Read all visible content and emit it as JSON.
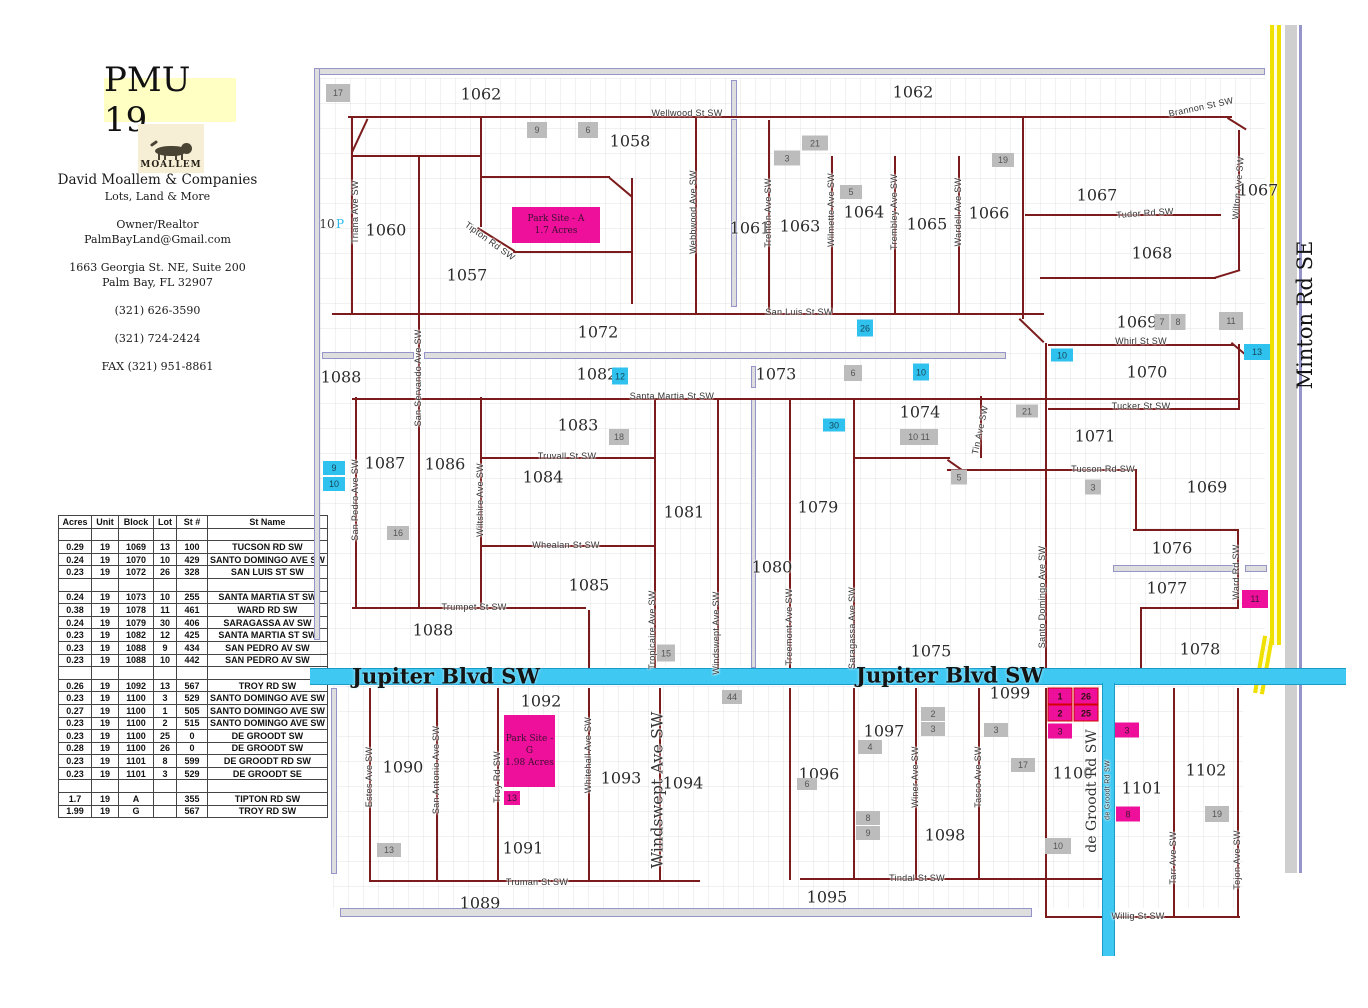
{
  "header": {
    "title": "PMU 19",
    "logo_text": "MOALLEM",
    "company": "David Moallem & Companies",
    "tagline": "Lots, Land & More",
    "role": "Owner/Realtor",
    "email": "PalmBayLand@Gmail.com",
    "address1": "1663 Georgia St. NE, Suite 200",
    "address2": "Palm Bay, FL   32907",
    "phone1": "(321) 626-3590",
    "phone2": "(321) 724-2424",
    "fax": "FAX (321) 951-8861"
  },
  "table": {
    "headers": [
      "Acres",
      "Unit",
      "Block",
      "Lot",
      "St #",
      "St Name"
    ],
    "rows": [
      [
        "",
        "",
        "",
        "",
        "",
        ""
      ],
      [
        "0.29",
        "19",
        "1069",
        "13",
        "100",
        "TUCSON RD SW"
      ],
      [
        "0.24",
        "19",
        "1070",
        "10",
        "429",
        "SANTO DOMINGO AVE SW"
      ],
      [
        "0.23",
        "19",
        "1072",
        "26",
        "328",
        "SAN LUIS ST SW"
      ],
      [
        "",
        "",
        "",
        "",
        "",
        ""
      ],
      [
        "0.24",
        "19",
        "1073",
        "10",
        "255",
        "SANTA MARTIA ST  SW"
      ],
      [
        "0.38",
        "19",
        "1078",
        "11",
        "461",
        "WARD RD SW"
      ],
      [
        "0.24",
        "19",
        "1079",
        "30",
        "406",
        "SARAGASSA AV  SW"
      ],
      [
        "0.23",
        "19",
        "1082",
        "12",
        "425",
        "SANTA MARTIA ST  SW"
      ],
      [
        "0.23",
        "19",
        "1088",
        "9",
        "434",
        "SAN PEDRO AV  SW"
      ],
      [
        "0.23",
        "19",
        "1088",
        "10",
        "442",
        "SAN PEDRO AV  SW"
      ],
      [
        "",
        "",
        "",
        "",
        "",
        ""
      ],
      [
        "0.26",
        "19",
        "1092",
        "13",
        "567",
        "TROY RD SW"
      ],
      [
        "0.23",
        "19",
        "1100",
        "3",
        "529",
        "SANTO DOMINGO AVE SW"
      ],
      [
        "0.27",
        "19",
        "1100",
        "1",
        "505",
        "SANTO DOMINGO AVE SW"
      ],
      [
        "0.23",
        "19",
        "1100",
        "2",
        "515",
        "SANTO DOMINGO AVE SW"
      ],
      [
        "0.23",
        "19",
        "1100",
        "25",
        "0",
        "DE GROODT SW"
      ],
      [
        "0.28",
        "19",
        "1100",
        "26",
        "0",
        "DE GROODT SW"
      ],
      [
        "0.23",
        "19",
        "1101",
        "8",
        "599",
        "DE GROODT RD  SW"
      ],
      [
        "0.23",
        "19",
        "1101",
        "3",
        "529",
        "DE GROODT  SE"
      ],
      [
        "",
        "",
        "",
        "",
        "",
        ""
      ],
      [
        "1.7",
        "19",
        "A",
        "",
        "355",
        "TIPTON RD  SW"
      ],
      [
        "1.99",
        "19",
        "G",
        "",
        "567",
        "TROY RD  SW"
      ]
    ]
  },
  "map": {
    "roads": {
      "jupiter": {
        "label": "Jupiter Blvd SW"
      },
      "minton": {
        "label": "Minton Rd SE"
      },
      "degroodt": {
        "label": "de Groodt Rd SW"
      }
    },
    "park_sites": [
      {
        "l1": "Park Site - A",
        "l2": "1.7 Acres",
        "x": 512,
        "y": 207,
        "w": 88,
        "h": 36
      },
      {
        "l1": "Park Site - G",
        "l2": "1.98 Acres",
        "x": 504,
        "y": 715,
        "w": 51,
        "h": 72
      }
    ],
    "block_labels": [
      {
        "t": "1062",
        "x": 481,
        "y": 94
      },
      {
        "t": "1062",
        "x": 913,
        "y": 92
      },
      {
        "t": "1058",
        "x": 630,
        "y": 141
      },
      {
        "t": "1060",
        "x": 386,
        "y": 230
      },
      {
        "t": "1057",
        "x": 467,
        "y": 275
      },
      {
        "t": "1061",
        "x": 750,
        "y": 228
      },
      {
        "t": "1063",
        "x": 800,
        "y": 226
      },
      {
        "t": "1064",
        "x": 864,
        "y": 212
      },
      {
        "t": "1065",
        "x": 927,
        "y": 224
      },
      {
        "t": "1066",
        "x": 989,
        "y": 213
      },
      {
        "t": "1067",
        "x": 1097,
        "y": 195
      },
      {
        "t": "1067",
        "x": 1258,
        "y": 190
      },
      {
        "t": "1068",
        "x": 1152,
        "y": 253
      },
      {
        "t": "1072",
        "x": 598,
        "y": 332
      },
      {
        "t": "1069",
        "x": 1137,
        "y": 322
      },
      {
        "t": "1070",
        "x": 1147,
        "y": 372
      },
      {
        "t": "1088",
        "x": 341,
        "y": 377
      },
      {
        "t": "1082",
        "x": 597,
        "y": 374
      },
      {
        "t": "1073",
        "x": 776,
        "y": 374
      },
      {
        "t": "1074",
        "x": 920,
        "y": 412
      },
      {
        "t": "1071",
        "x": 1095,
        "y": 436
      },
      {
        "t": "1083",
        "x": 578,
        "y": 425
      },
      {
        "t": "1087",
        "x": 385,
        "y": 463
      },
      {
        "t": "1086",
        "x": 445,
        "y": 464
      },
      {
        "t": "1084",
        "x": 543,
        "y": 477
      },
      {
        "t": "1081",
        "x": 684,
        "y": 512
      },
      {
        "t": "1079",
        "x": 818,
        "y": 507
      },
      {
        "t": "1069",
        "x": 1207,
        "y": 487
      },
      {
        "t": "1080",
        "x": 772,
        "y": 567
      },
      {
        "t": "1076",
        "x": 1172,
        "y": 548
      },
      {
        "t": "1085",
        "x": 589,
        "y": 585
      },
      {
        "t": "1077",
        "x": 1167,
        "y": 588
      },
      {
        "t": "1088",
        "x": 433,
        "y": 630
      },
      {
        "t": "1075",
        "x": 931,
        "y": 651
      },
      {
        "t": "1078",
        "x": 1200,
        "y": 649
      },
      {
        "t": "1092",
        "x": 541,
        "y": 701
      },
      {
        "t": "1099",
        "x": 1010,
        "y": 693
      },
      {
        "t": "1090",
        "x": 403,
        "y": 767
      },
      {
        "t": "1093",
        "x": 621,
        "y": 778
      },
      {
        "t": "1094",
        "x": 683,
        "y": 783
      },
      {
        "t": "1097",
        "x": 884,
        "y": 731
      },
      {
        "t": "1096",
        "x": 819,
        "y": 774
      },
      {
        "t": "1100",
        "x": 1073,
        "y": 773
      },
      {
        "t": "1101",
        "x": 1142,
        "y": 788
      },
      {
        "t": "1102",
        "x": 1206,
        "y": 770
      },
      {
        "t": "1091",
        "x": 523,
        "y": 848
      },
      {
        "t": "1098",
        "x": 945,
        "y": 835
      },
      {
        "t": "1089",
        "x": 480,
        "y": 903
      },
      {
        "t": "1095",
        "x": 827,
        "y": 897
      }
    ],
    "street_labels": [
      {
        "t": "Wellwood St SW",
        "x": 687,
        "y": 113
      },
      {
        "t": "San Luis St SW",
        "x": 799,
        "y": 312
      },
      {
        "t": "Whirl St SW",
        "x": 1141,
        "y": 341
      },
      {
        "t": "Santa Martia St SW",
        "x": 672,
        "y": 396
      },
      {
        "t": "Tucker St SW",
        "x": 1141,
        "y": 406
      },
      {
        "t": "Truvall St SW",
        "x": 567,
        "y": 456
      },
      {
        "t": "Tucson Rd SW",
        "x": 1103,
        "y": 469
      },
      {
        "t": "Whealan St SW",
        "x": 566,
        "y": 545
      },
      {
        "t": "Trumpet St SW",
        "x": 474,
        "y": 607
      },
      {
        "t": "Tudor Rd SW",
        "x": 1145,
        "y": 213,
        "r": -4
      },
      {
        "t": "Tindal St SW",
        "x": 917,
        "y": 878
      },
      {
        "t": "Truman St SW",
        "x": 537,
        "y": 882
      },
      {
        "t": "Willig St SW",
        "x": 1138,
        "y": 916
      },
      {
        "t": "Brannon St SW",
        "x": 1201,
        "y": 107,
        "r": -12
      },
      {
        "t": "Tipton Rd SW",
        "x": 490,
        "y": 241,
        "r": 36
      },
      {
        "t": "Triana Ave SW",
        "x": 355,
        "y": 212,
        "r": -90
      },
      {
        "t": "Webbwood Ave SW",
        "x": 693,
        "y": 212,
        "r": -90
      },
      {
        "t": "Trenton Ave SW",
        "x": 768,
        "y": 213,
        "r": -90
      },
      {
        "t": "Wilmette Ave SW",
        "x": 831,
        "y": 210,
        "r": -90
      },
      {
        "t": "Trembley Ave SW",
        "x": 894,
        "y": 212,
        "r": -90
      },
      {
        "t": "Wardell Ave SW",
        "x": 958,
        "y": 212,
        "r": -90
      },
      {
        "t": "Wilton Ave SW",
        "x": 1238,
        "y": 188,
        "r": -85
      },
      {
        "t": "San Servando Ave SW",
        "x": 418,
        "y": 378,
        "r": -90
      },
      {
        "t": "San Pedro Ave SW",
        "x": 355,
        "y": 500,
        "r": -90
      },
      {
        "t": "Wiltshire Ave SW",
        "x": 480,
        "y": 500,
        "r": -90
      },
      {
        "t": "Tin Ave SW",
        "x": 980,
        "y": 430,
        "r": -78
      },
      {
        "t": "Santo Domingo Ave SW",
        "x": 1042,
        "y": 597,
        "r": -90
      },
      {
        "t": "Ward Rd SW",
        "x": 1236,
        "y": 572,
        "r": -90
      },
      {
        "t": "Tropicaire Ave SW",
        "x": 652,
        "y": 630,
        "r": -90
      },
      {
        "t": "Windswept Ave SW",
        "x": 716,
        "y": 633,
        "r": -90
      },
      {
        "t": "Treemont Ave SW",
        "x": 789,
        "y": 627,
        "r": -90
      },
      {
        "t": "Saragassa Ave SW",
        "x": 852,
        "y": 628,
        "r": -90
      },
      {
        "t": "Estes Ave SW",
        "x": 369,
        "y": 777,
        "r": -90
      },
      {
        "t": "San Antonio Ave SW",
        "x": 436,
        "y": 770,
        "r": -90
      },
      {
        "t": "Troy Rd SW",
        "x": 497,
        "y": 777,
        "r": -90
      },
      {
        "t": "Whitehall Ave SW",
        "x": 588,
        "y": 755,
        "r": -90
      },
      {
        "t": "Winer Ave SW",
        "x": 915,
        "y": 777,
        "r": -90
      },
      {
        "t": "Tasco Ave SW",
        "x": 978,
        "y": 777,
        "r": -90
      },
      {
        "t": "Tarr Ave SW",
        "x": 1173,
        "y": 858,
        "r": -90
      },
      {
        "t": "Tejon Ave SW",
        "x": 1237,
        "y": 860,
        "r": -90
      },
      {
        "t": "Windswept Ave SW",
        "x": 657,
        "y": 790,
        "r": -90,
        "s": 16,
        "serif": true
      },
      {
        "t": "de Groodt Rd SW",
        "x": 1092,
        "y": 791,
        "r": -90,
        "s": 14,
        "serif": true
      },
      {
        "t": "de Groodt Rd SW",
        "x": 1108,
        "y": 790,
        "r": -90,
        "s": 7
      },
      {
        "t": "10",
        "x": 327,
        "y": 224,
        "s": 12,
        "serif": true
      },
      {
        "t": "P",
        "x": 340,
        "y": 224,
        "s": 12,
        "serif": true,
        "col": "#2bb7e8"
      }
    ],
    "markers": [
      {
        "t": "17",
        "x": 338,
        "y": 93,
        "c": "g",
        "w": 24,
        "h": 18
      },
      {
        "t": "9",
        "x": 537,
        "y": 130,
        "c": "g",
        "w": 20,
        "h": 16
      },
      {
        "t": "6",
        "x": 588,
        "y": 130,
        "c": "g",
        "w": 20,
        "h": 16
      },
      {
        "t": "3",
        "x": 787,
        "y": 158,
        "c": "g",
        "w": 26,
        "h": 15
      },
      {
        "t": "21",
        "x": 815,
        "y": 143,
        "c": "g",
        "w": 26,
        "h": 15
      },
      {
        "t": "5",
        "x": 851,
        "y": 192,
        "c": "g",
        "w": 22,
        "h": 14
      },
      {
        "t": "19",
        "x": 1003,
        "y": 160,
        "c": "g",
        "w": 22,
        "h": 14
      },
      {
        "t": "7",
        "x": 1162,
        "y": 322,
        "c": "g",
        "w": 15,
        "h": 16
      },
      {
        "t": "8",
        "x": 1178,
        "y": 322,
        "c": "g",
        "w": 15,
        "h": 16
      },
      {
        "t": "11",
        "x": 1231,
        "y": 321,
        "c": "g",
        "w": 24,
        "h": 18
      },
      {
        "t": "26",
        "x": 865,
        "y": 328,
        "c": "c",
        "w": 16,
        "h": 17
      },
      {
        "t": "12",
        "x": 620,
        "y": 376,
        "c": "c",
        "w": 16,
        "h": 17
      },
      {
        "t": "6",
        "x": 853,
        "y": 373,
        "c": "g",
        "w": 18,
        "h": 16
      },
      {
        "t": "10",
        "x": 921,
        "y": 372,
        "c": "c",
        "w": 16,
        "h": 17
      },
      {
        "t": "10",
        "x": 1062,
        "y": 355,
        "c": "c",
        "w": 22,
        "h": 13
      },
      {
        "t": "13",
        "x": 1257,
        "y": 352,
        "c": "c",
        "w": 26,
        "h": 16
      },
      {
        "t": "18",
        "x": 619,
        "y": 437,
        "c": "g",
        "w": 20,
        "h": 16
      },
      {
        "t": "21",
        "x": 1027,
        "y": 411,
        "c": "g",
        "w": 22,
        "h": 13
      },
      {
        "t": "10  11",
        "x": 919,
        "y": 437,
        "c": "g",
        "w": 38,
        "h": 16
      },
      {
        "t": "30",
        "x": 834,
        "y": 425,
        "c": "c",
        "w": 22,
        "h": 13
      },
      {
        "t": "9",
        "x": 334,
        "y": 468,
        "c": "c",
        "w": 22,
        "h": 14
      },
      {
        "t": "10",
        "x": 334,
        "y": 484,
        "c": "c",
        "w": 22,
        "h": 14
      },
      {
        "t": "5",
        "x": 959,
        "y": 477,
        "c": "g",
        "w": 16,
        "h": 15
      },
      {
        "t": "3",
        "x": 1093,
        "y": 487,
        "c": "g",
        "w": 16,
        "h": 15
      },
      {
        "t": "16",
        "x": 398,
        "y": 533,
        "c": "g",
        "w": 22,
        "h": 14
      },
      {
        "t": "11",
        "x": 1255,
        "y": 599,
        "c": "m",
        "w": 26,
        "h": 18
      },
      {
        "t": "15",
        "x": 666,
        "y": 653,
        "c": "g",
        "w": 18,
        "h": 17
      },
      {
        "t": "44",
        "x": 732,
        "y": 697,
        "c": "g",
        "w": 20,
        "h": 14
      },
      {
        "t": "1",
        "x": 1060,
        "y": 696,
        "c": "mr",
        "w": 25,
        "h": 17
      },
      {
        "t": "26",
        "x": 1086,
        "y": 696,
        "c": "mr",
        "w": 25,
        "h": 17
      },
      {
        "t": "2",
        "x": 1060,
        "y": 713,
        "c": "mr",
        "w": 25,
        "h": 17
      },
      {
        "t": "25",
        "x": 1086,
        "y": 713,
        "c": "mr",
        "w": 25,
        "h": 17
      },
      {
        "t": "3",
        "x": 1060,
        "y": 731,
        "c": "m",
        "w": 24,
        "h": 15
      },
      {
        "t": "3",
        "x": 1127,
        "y": 730,
        "c": "m",
        "w": 24,
        "h": 15
      },
      {
        "t": "2",
        "x": 933,
        "y": 714,
        "c": "g",
        "w": 24,
        "h": 14
      },
      {
        "t": "3",
        "x": 933,
        "y": 729,
        "c": "g",
        "w": 24,
        "h": 14
      },
      {
        "t": "3",
        "x": 996,
        "y": 730,
        "c": "g",
        "w": 24,
        "h": 14
      },
      {
        "t": "4",
        "x": 870,
        "y": 747,
        "c": "g",
        "w": 24,
        "h": 14
      },
      {
        "t": "17",
        "x": 1023,
        "y": 765,
        "c": "g",
        "w": 24,
        "h": 14
      },
      {
        "t": "6",
        "x": 807,
        "y": 784,
        "c": "g",
        "w": 20,
        "h": 12
      },
      {
        "t": "8",
        "x": 868,
        "y": 818,
        "c": "g",
        "w": 24,
        "h": 14
      },
      {
        "t": "9",
        "x": 868,
        "y": 833,
        "c": "g",
        "w": 24,
        "h": 14
      },
      {
        "t": "8",
        "x": 1128,
        "y": 814,
        "c": "m",
        "w": 24,
        "h": 15
      },
      {
        "t": "19",
        "x": 1217,
        "y": 814,
        "c": "g",
        "w": 24,
        "h": 16
      },
      {
        "t": "10",
        "x": 1058,
        "y": 846,
        "c": "g",
        "w": 26,
        "h": 16
      },
      {
        "t": "13",
        "x": 389,
        "y": 850,
        "c": "g",
        "w": 24,
        "h": 14
      },
      {
        "t": "13",
        "x": 512,
        "y": 798,
        "c": "m",
        "w": 16,
        "h": 14
      }
    ]
  }
}
